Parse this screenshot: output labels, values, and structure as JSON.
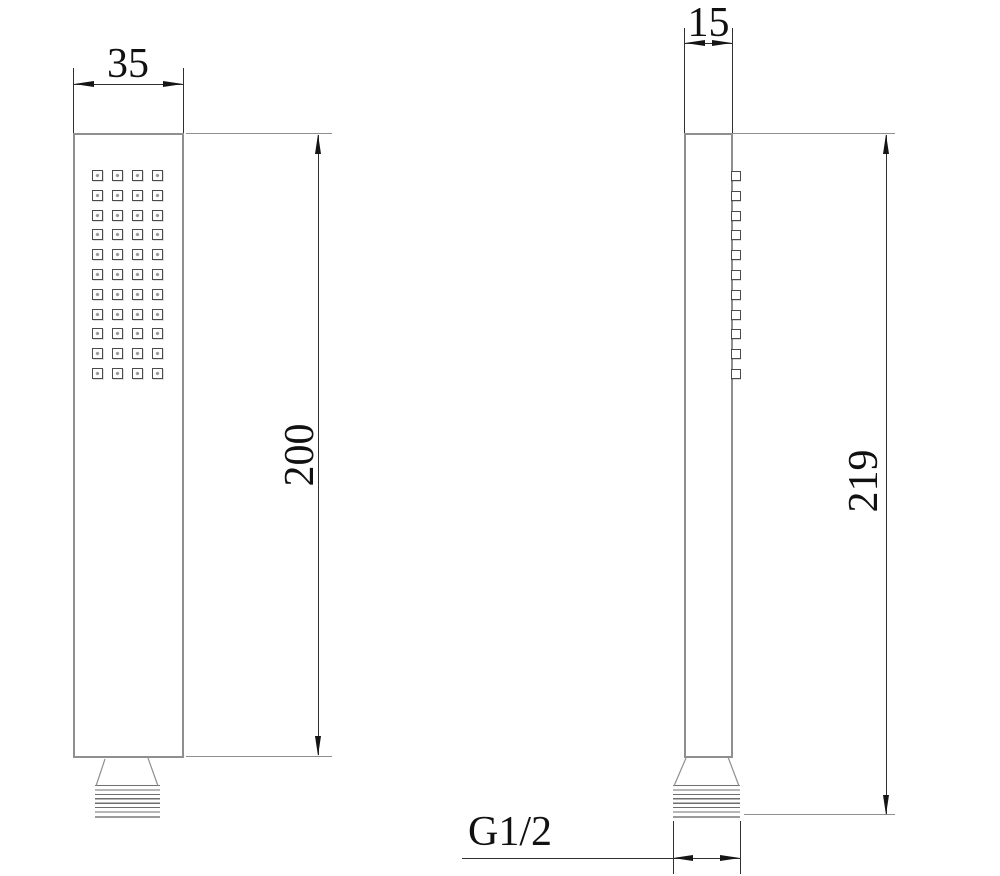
{
  "drawing": {
    "views": {
      "front": {
        "width_label": "35",
        "height_label": "200",
        "nozzles": {
          "rows": 11,
          "cols": 4
        }
      },
      "side": {
        "width_label": "15",
        "height_label": "219",
        "thread_label": "G1/2",
        "nozzles": {
          "rows": 11,
          "cols": 1
        }
      }
    },
    "colors": {
      "outline": "#8f8f8f",
      "detail": "#4a4a4a",
      "dimension": "#2f2f2f",
      "arrow": "#151515",
      "text": "#111111",
      "background": "#ffffff"
    }
  }
}
